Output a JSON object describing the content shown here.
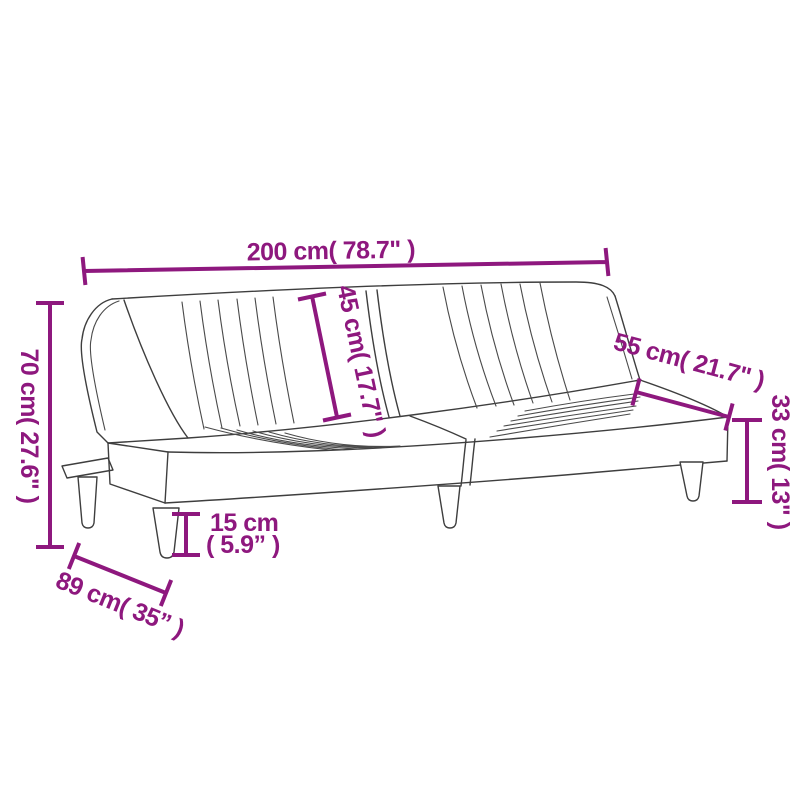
{
  "colors": {
    "dimension_accent": "#8E187E",
    "sketch_line": "#3E3E3E",
    "background": "#FFFFFF"
  },
  "diagram": {
    "subject": "sofa-bed line sketch with dimension annotations",
    "dimensions": {
      "width": {
        "label": "200 cm( 78.7\" )",
        "cm": 200,
        "inches": 78.7
      },
      "backrest_height": {
        "label": "45 cm( 17.7\" )",
        "cm": 45,
        "inches": 17.7
      },
      "seat_depth_top": {
        "label": "55 cm( 21.7\" )",
        "cm": 55,
        "inches": 21.7
      },
      "seat_height": {
        "label": "33 cm( 13\" )",
        "cm": 33,
        "inches": 13
      },
      "overall_height": {
        "label": "70 cm( 27.6\" )",
        "cm": 70,
        "inches": 27.6
      },
      "leg_height": {
        "line1": "15 cm",
        "line2": "( 5.9” )",
        "cm": 15,
        "inches": 5.9
      },
      "depth": {
        "label": "89 cm( 35” )",
        "cm": 89,
        "inches": 35
      }
    }
  }
}
